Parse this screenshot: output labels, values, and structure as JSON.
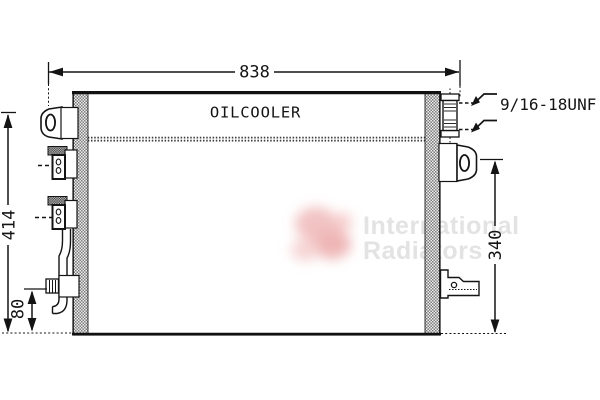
{
  "labels": {
    "oilcooler": "OILCOOLER",
    "thread_spec": "9/16-18UNF"
  },
  "dimensions": {
    "overall_width": "838",
    "overall_height": "414",
    "bottom_offset": "80",
    "right_height": "340"
  },
  "watermark": {
    "line1": "International",
    "line2": "Radiators",
    "text_color": "#e3e3e3",
    "logo_color": "#f2c0c0"
  },
  "colors": {
    "background": "#ffffff",
    "line": "#141414",
    "hatch_fill": "#8a8a8a"
  }
}
